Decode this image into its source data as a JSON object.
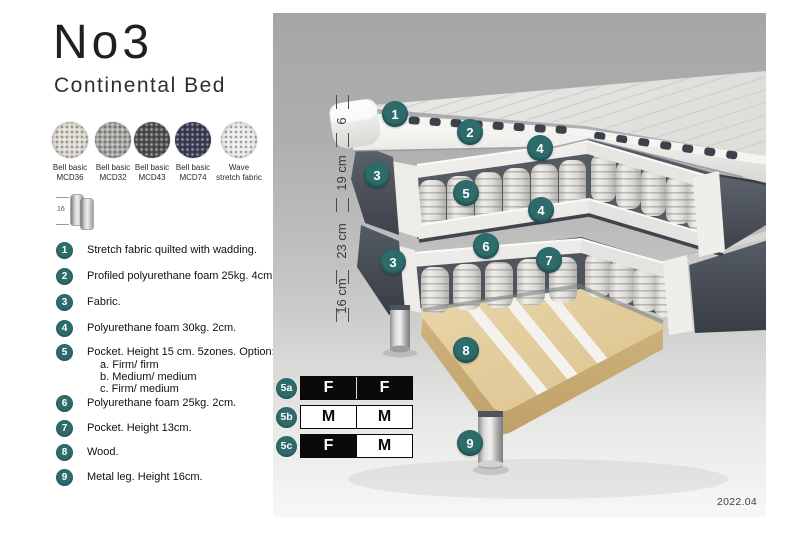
{
  "header": {
    "title": "No3",
    "subtitle": "Continental Bed"
  },
  "swatches": {
    "items": [
      {
        "line1": "Bell basic",
        "line2": "MCD36",
        "color": "#ddd8d0"
      },
      {
        "line1": "Bell basic",
        "line2": "MCD32",
        "color": "#a9a7a4"
      },
      {
        "line1": "Bell basic",
        "line2": "MCD43",
        "color": "#545250"
      },
      {
        "line1": "Bell basic",
        "line2": "MCD74",
        "color": "#3c4057"
      },
      {
        "line1": "Wave",
        "line2": "stretch fabric",
        "color": "#e8eaec"
      }
    ]
  },
  "leg_icon": {
    "label": "16"
  },
  "legend": {
    "items": [
      {
        "num": "1",
        "text": "Stretch fabric quilted with wadding."
      },
      {
        "num": "2",
        "text": "Profiled polyurethane foam 25kg. 4cm."
      },
      {
        "num": "3",
        "text": "Fabric."
      },
      {
        "num": "4",
        "text": "Polyurethane foam 30kg. 2cm."
      },
      {
        "num": "5",
        "text": "Pocket. Height 15 cm. 5zones. Option:",
        "options": [
          "a. Firm/ firm",
          "b. Medium/ medium",
          "c. Firm/ medium"
        ]
      },
      {
        "num": "6",
        "text": "Polyurethane foam 25kg. 2cm."
      },
      {
        "num": "7",
        "text": "Pocket. Height 13cm."
      },
      {
        "num": "8",
        "text": "Wood."
      },
      {
        "num": "9",
        "text": "Metal leg. Height 16cm."
      }
    ]
  },
  "diagram": {
    "callouts": [
      {
        "num": "1",
        "x": 122,
        "y": 101
      },
      {
        "num": "2",
        "x": 197,
        "y": 119
      },
      {
        "num": "4",
        "x": 267,
        "y": 135
      },
      {
        "num": "3",
        "x": 104,
        "y": 162
      },
      {
        "num": "5",
        "x": 193,
        "y": 180
      },
      {
        "num": "4",
        "x": 268,
        "y": 197
      },
      {
        "num": "6",
        "x": 213,
        "y": 233
      },
      {
        "num": "7",
        "x": 276,
        "y": 247
      },
      {
        "num": "3",
        "x": 120,
        "y": 249
      },
      {
        "num": "8",
        "x": 193,
        "y": 337
      },
      {
        "num": "9",
        "x": 197,
        "y": 430
      }
    ],
    "ruler": {
      "ticks": [
        89,
        127,
        192,
        264,
        302
      ],
      "labels": [
        {
          "text": "6",
          "y": 108
        },
        {
          "text": "19 cm",
          "y": 160
        },
        {
          "text": "23 cm",
          "y": 228
        },
        {
          "text": "16 cm",
          "y": 283
        }
      ]
    },
    "firmness": [
      {
        "id": "5a",
        "y": 363,
        "cells": [
          {
            "letter": "F",
            "filled": true
          },
          {
            "letter": "F",
            "filled": true
          }
        ]
      },
      {
        "id": "5b",
        "y": 392,
        "cells": [
          {
            "letter": "M",
            "filled": false
          },
          {
            "letter": "M",
            "filled": false
          }
        ]
      },
      {
        "id": "5c",
        "y": 421,
        "cells": [
          {
            "letter": "F",
            "filled": true
          },
          {
            "letter": "M",
            "filled": false
          }
        ]
      }
    ],
    "version": "2022.04"
  },
  "colors": {
    "accent": "#2e6c6c",
    "callout": "#2e6c6c",
    "black_cell": "#0a0a0a"
  }
}
